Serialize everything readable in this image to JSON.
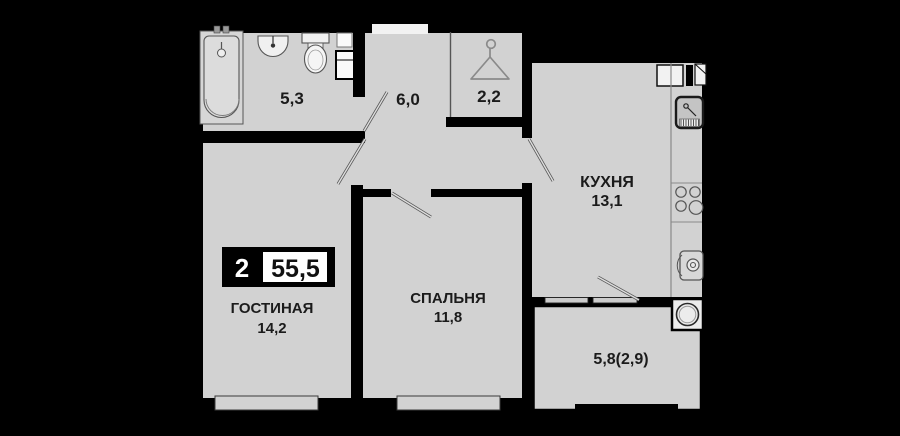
{
  "plan": {
    "title": "apartment-floor-plan",
    "badge": {
      "rooms": "2",
      "total_area": "55,5"
    },
    "rooms": {
      "bathroom": {
        "area": "5,3"
      },
      "hallway": {
        "area": "6,0"
      },
      "wardrobe": {
        "area": "2,2"
      },
      "kitchen": {
        "name": "КУХНЯ",
        "area": "13,1"
      },
      "living": {
        "name": "ГОСТИНАЯ",
        "area": "14,2"
      },
      "bedroom": {
        "name": "СПАЛЬНЯ",
        "area": "11,8"
      },
      "balcony": {
        "area": "5,8(2,9)"
      }
    },
    "icons": {
      "bathtub": "bathtub-icon",
      "sink": "sink-icon",
      "toilet": "toilet-icon",
      "hanger": "hanger-icon",
      "kitchen_sink": "kitchen-sink-icon",
      "stove": "stove-icon",
      "washing_machine": "washing-machine-icon",
      "boiler": "boiler-icon"
    },
    "colors": {
      "background": "#000000",
      "floor": "#d2d2d2",
      "wall": "#000000",
      "text": "#1b1b1b",
      "badge_bg": "#000000",
      "badge_value_bg": "#ffffff"
    }
  }
}
